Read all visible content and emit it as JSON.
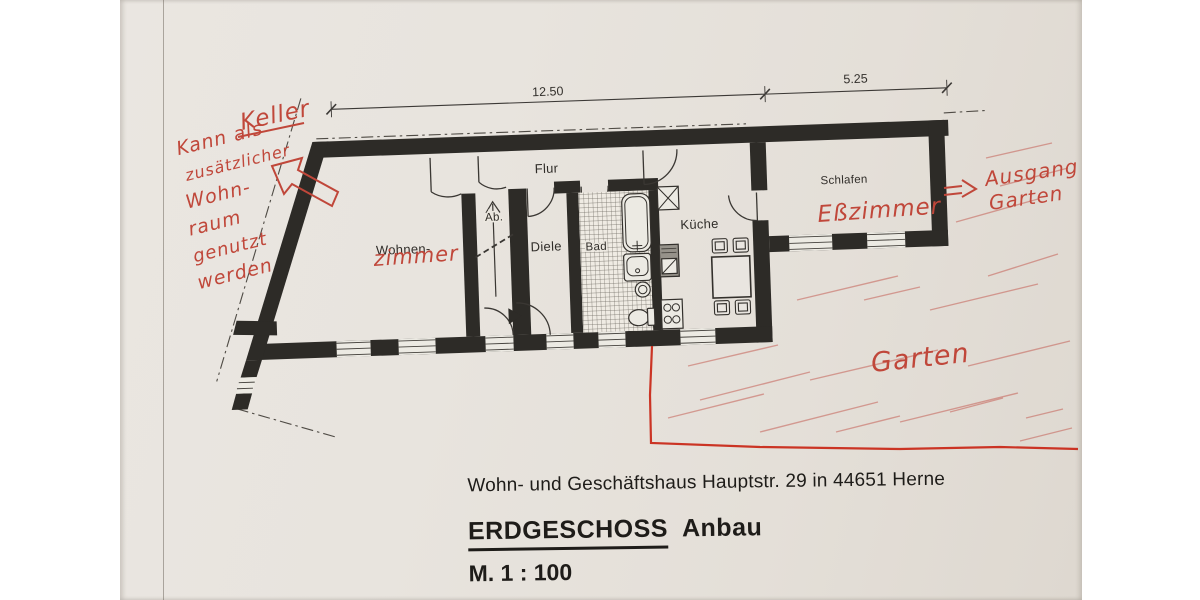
{
  "colors": {
    "paper": "#e8e4de",
    "wall_ink": "#2d2b27",
    "annotation_red": "#c0473a",
    "boundary_red": "#c92a1a"
  },
  "dimension_labels": {
    "total": "12.50",
    "annex": "5.25"
  },
  "rooms": {
    "flur": "Flur",
    "ab": "Ab.",
    "wohnen": "Wohnen-",
    "diele": "Diele",
    "bad": "Bad",
    "kueche": "Küche",
    "schlafen": "Schlafen"
  },
  "annotations": {
    "color": "#c0473a",
    "keller": "Keller",
    "note": [
      "Kann als",
      "zusätzlicher",
      "Wohn-",
      "raum",
      "genutzt",
      "werden"
    ],
    "wohnzimmer_suffix": "zimmer",
    "esszimmer": "Eßzimmer",
    "ausgang_line1": "Ausgang",
    "ausgang_line2": "Garten",
    "garten": "Garten"
  },
  "footer": {
    "address": "Wohn- und Geschäftshaus  Hauptstr. 29 in 44651 Herne",
    "title": "ERDGESCHOSS",
    "title_suffix": "Anbau",
    "scale": "M. 1 : 100"
  }
}
